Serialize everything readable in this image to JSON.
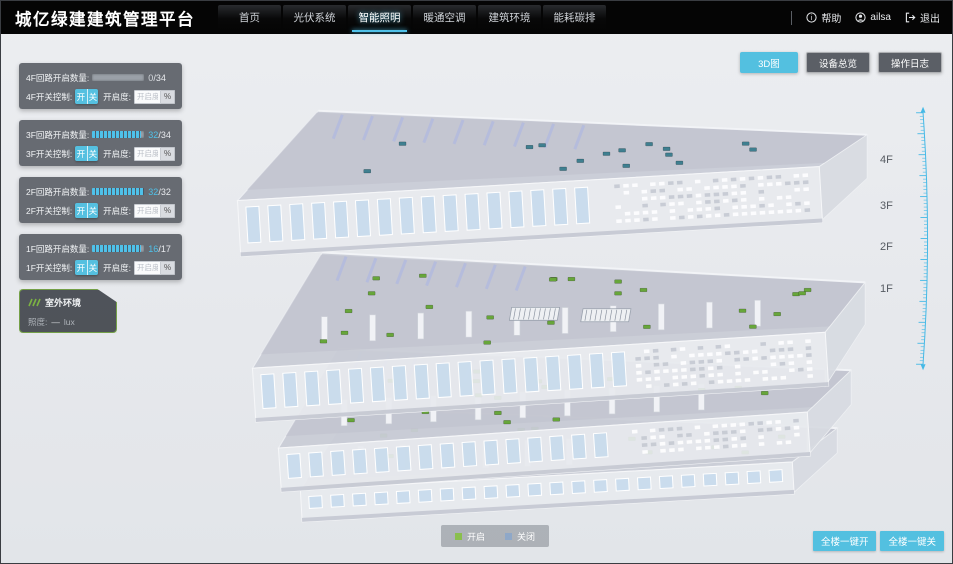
{
  "header": {
    "title": "城亿绿建建筑管理平台",
    "nav": [
      {
        "label": "首页",
        "active": false
      },
      {
        "label": "光伏系统",
        "active": false
      },
      {
        "label": "智能照明",
        "active": true
      },
      {
        "label": "暖通空调",
        "active": false
      },
      {
        "label": "建筑环境",
        "active": false
      },
      {
        "label": "能耗碳排",
        "active": false
      }
    ],
    "help_label": "帮助",
    "user_name": "ailsa",
    "logout_label": "退出"
  },
  "view_buttons": [
    {
      "label": "3D图",
      "active": true
    },
    {
      "label": "设备总览",
      "active": false
    },
    {
      "label": "操作日志",
      "active": false
    }
  ],
  "floor_panels": [
    {
      "floor": "4F",
      "circuit_label": "4F回路开启数量:",
      "open_count": "0",
      "total": "34",
      "fill_pct": 0,
      "switch_label": "4F开关控制:",
      "on_label": "开",
      "off_label": "关",
      "dim_label": "开启度:",
      "dim_placeholder": "开启度",
      "percent": "%"
    },
    {
      "floor": "3F",
      "circuit_label": "3F回路开启数量:",
      "open_count": "32",
      "total": "34",
      "fill_pct": 94,
      "switch_label": "3F开关控制:",
      "on_label": "开",
      "off_label": "关",
      "dim_label": "开启度:",
      "dim_placeholder": "开启度",
      "percent": "%"
    },
    {
      "floor": "2F",
      "circuit_label": "2F回路开启数量:",
      "open_count": "32",
      "total": "32",
      "fill_pct": 100,
      "switch_label": "2F开关控制:",
      "on_label": "开",
      "off_label": "关",
      "dim_label": "开启度:",
      "dim_placeholder": "开启度",
      "percent": "%"
    },
    {
      "floor": "1F",
      "circuit_label": "1F回路开启数量:",
      "open_count": "16",
      "total": "17",
      "fill_pct": 94,
      "switch_label": "1F开关控制:",
      "on_label": "开",
      "off_label": "关",
      "dim_label": "开启度:",
      "dim_placeholder": "开启度",
      "percent": "%"
    }
  ],
  "outdoor_panel": {
    "title": "室外环境",
    "metric_label": "照度:",
    "value": "—",
    "unit": "lux"
  },
  "floor_scale_labels": [
    {
      "label": "4F",
      "top": 153
    },
    {
      "label": "3F",
      "top": 199
    },
    {
      "label": "2F",
      "top": 240
    },
    {
      "label": "1F",
      "top": 282
    }
  ],
  "legend": [
    {
      "label": "开启",
      "color": "#8abf4d"
    },
    {
      "label": "关闭",
      "color": "#8fa8c8"
    }
  ],
  "bulk_buttons": [
    {
      "label": "全楼一键开"
    },
    {
      "label": "全楼一键关"
    }
  ],
  "colors": {
    "accent": "#53c0e0",
    "progress": "#4fc1e9",
    "marker_on": "#67a63a",
    "marker_off": "#3f7f90",
    "ruler": "#45b9e6"
  }
}
